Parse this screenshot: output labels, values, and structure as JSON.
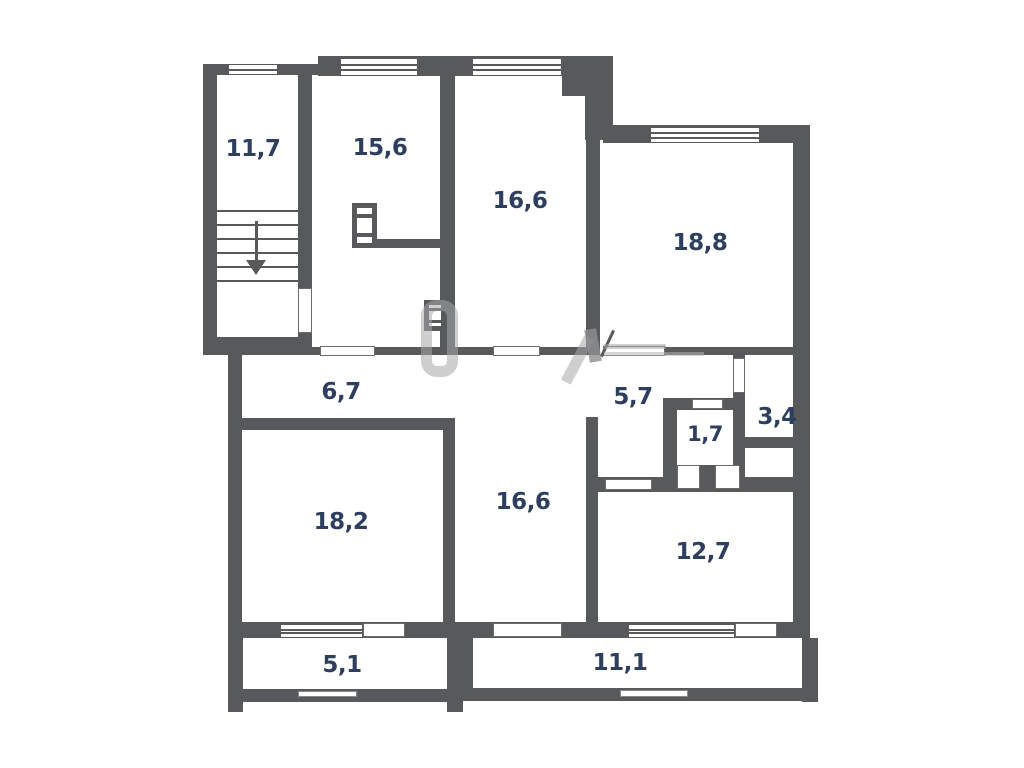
{
  "plan": {
    "type": "apartment-floor-plan",
    "rooms": [
      {
        "id": "stairwell",
        "area": "11,7"
      },
      {
        "id": "room-top-left",
        "area": "15,6"
      },
      {
        "id": "room-top-center",
        "area": "16,6"
      },
      {
        "id": "room-top-right",
        "area": "18,8"
      },
      {
        "id": "corridor",
        "area": "6,7"
      },
      {
        "id": "hallway",
        "area": "5,7"
      },
      {
        "id": "wc",
        "area": "1,7"
      },
      {
        "id": "storage",
        "area": "3,4"
      },
      {
        "id": "room-bottom-left",
        "area": "18,2"
      },
      {
        "id": "room-bottom-center",
        "area": "16,6"
      },
      {
        "id": "room-bottom-right",
        "area": "12,7"
      },
      {
        "id": "balcony-left",
        "area": "5,1"
      },
      {
        "id": "balcony-right",
        "area": "11,1"
      }
    ],
    "colors": {
      "wall": "#58595b",
      "label": "#2d3e5f",
      "background": "#ffffff",
      "watermark": "#a8a8a8"
    }
  }
}
